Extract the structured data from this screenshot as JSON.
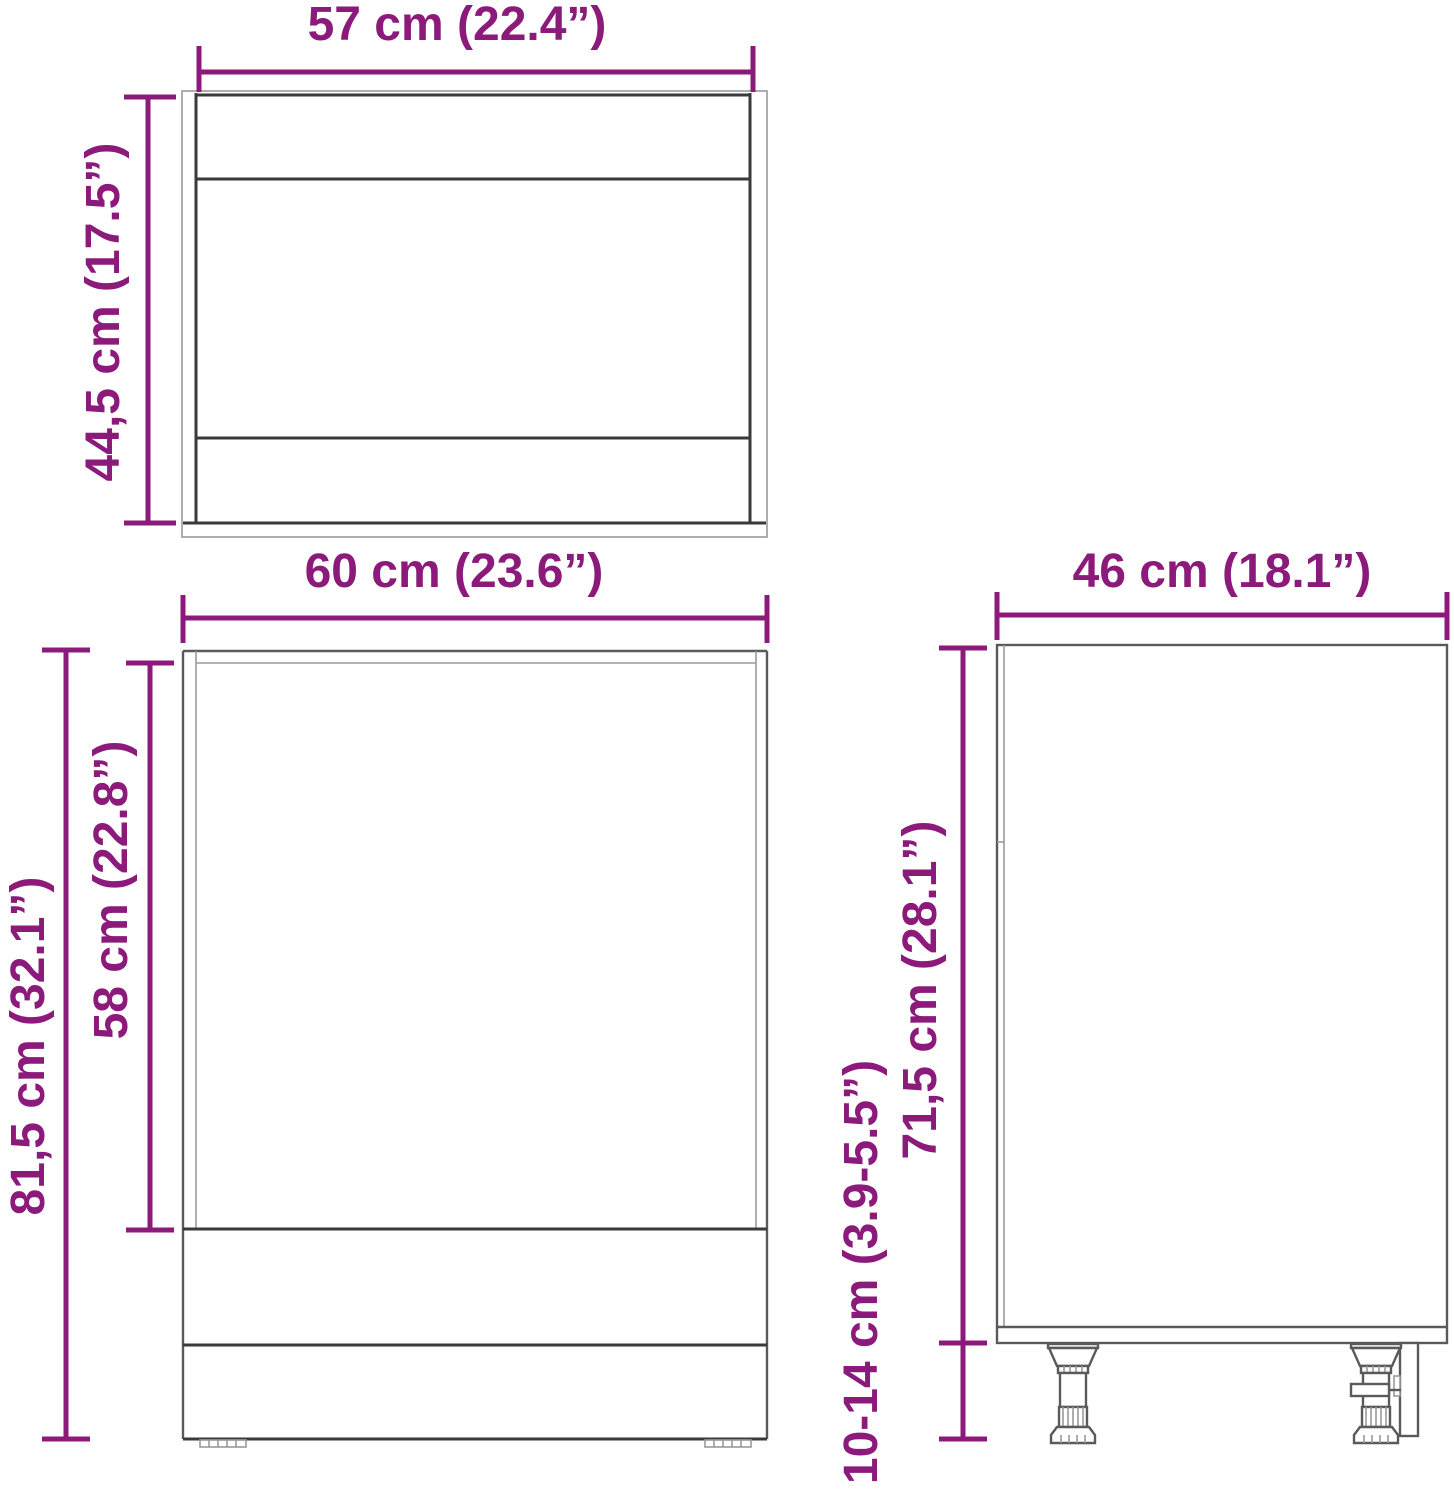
{
  "diagram": {
    "accent_color": "#8b1a7b",
    "line_color_dark": "#3a3a3a",
    "line_color_mid": "#5a5a5a",
    "line_color_light": "#9a9a9a",
    "views": {
      "top_view": {
        "name": "cabinet-top-view",
        "width": {
          "label": "57 cm (22.4”)",
          "value_cm": "57",
          "value_in": "22.4"
        },
        "depth": {
          "label": "44,5 cm (17.5”)",
          "value_cm": "44,5",
          "value_in": "17.5"
        }
      },
      "front_view": {
        "name": "cabinet-front-view",
        "width": {
          "label": "60 cm (23.6”)",
          "value_cm": "60",
          "value_in": "23.6"
        },
        "total_height": {
          "label": "81,5 cm (32.1”)",
          "value_cm": "81,5",
          "value_in": "32.1"
        },
        "door_height": {
          "label": "58 cm (22.8”)",
          "value_cm": "58",
          "value_in": "22.8"
        }
      },
      "side_view": {
        "name": "cabinet-side-view",
        "depth": {
          "label": "46 cm (18.1”)",
          "value_cm": "46",
          "value_in": "18.1"
        },
        "body_height": {
          "label": "71,5 cm (28.1”)",
          "value_cm": "71,5",
          "value_in": "28.1"
        },
        "leg_height": {
          "label": "10-14 cm (3.9-5.5”)",
          "value_cm": "10-14",
          "value_in": "3.9-5.5"
        }
      }
    }
  }
}
